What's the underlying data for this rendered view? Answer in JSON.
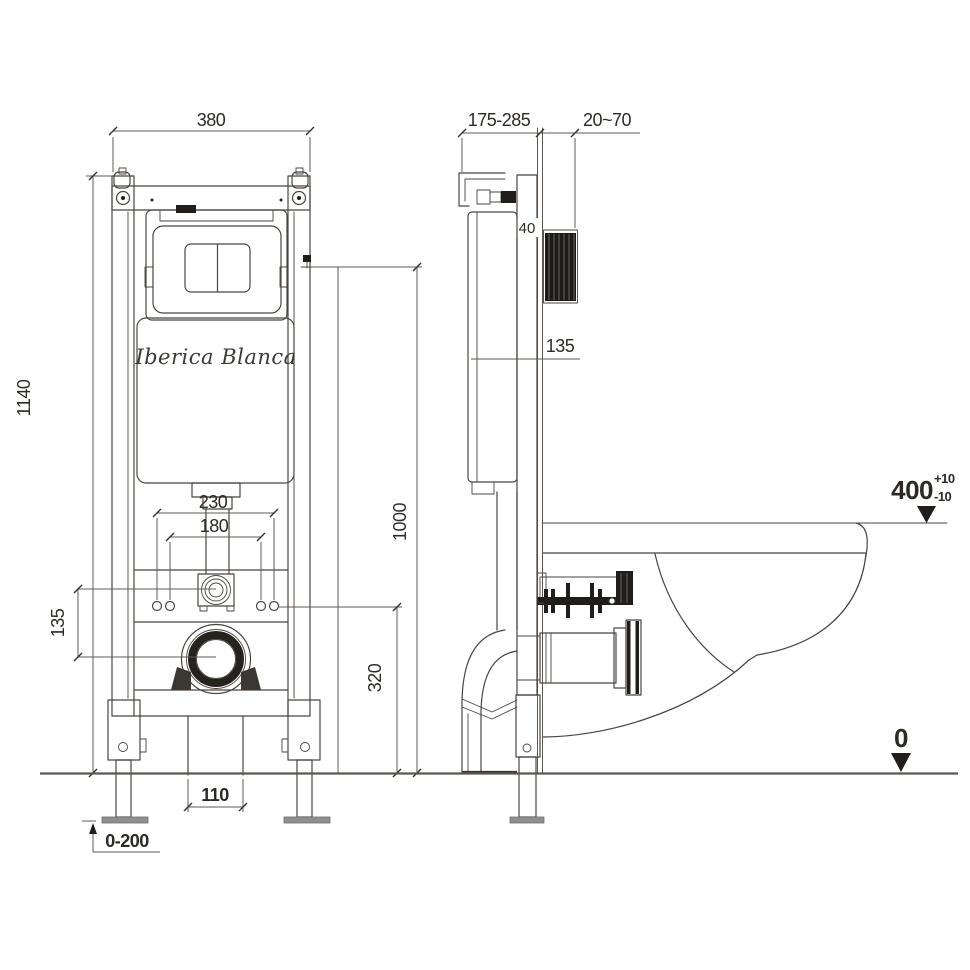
{
  "brand": {
    "logo": "Iberica Blanca"
  },
  "front_view": {
    "dim_width": "380",
    "dim_height": "1140",
    "dim_bolt_outer": "230",
    "dim_bolt_inner": "180",
    "dim_inlet_to_drain": "135",
    "dim_drain_height": "320",
    "dim_plate_height": "1000",
    "dim_drain_width": "110",
    "dim_foot_adjust": "0-200"
  },
  "side_view": {
    "dim_depth": "175-285",
    "dim_wall": "20~70",
    "dim_rail_depth": "40",
    "dim_tank": "135",
    "level_rim": "400",
    "tol_plus": "+10",
    "tol_minus": "-10",
    "level_floor": "0"
  },
  "colors": {
    "line": "#4a4540",
    "text": "#2d2925",
    "dark_fill": "#201d1b",
    "foot_plate": "#8f8f8f",
    "background": "#ffffff"
  }
}
